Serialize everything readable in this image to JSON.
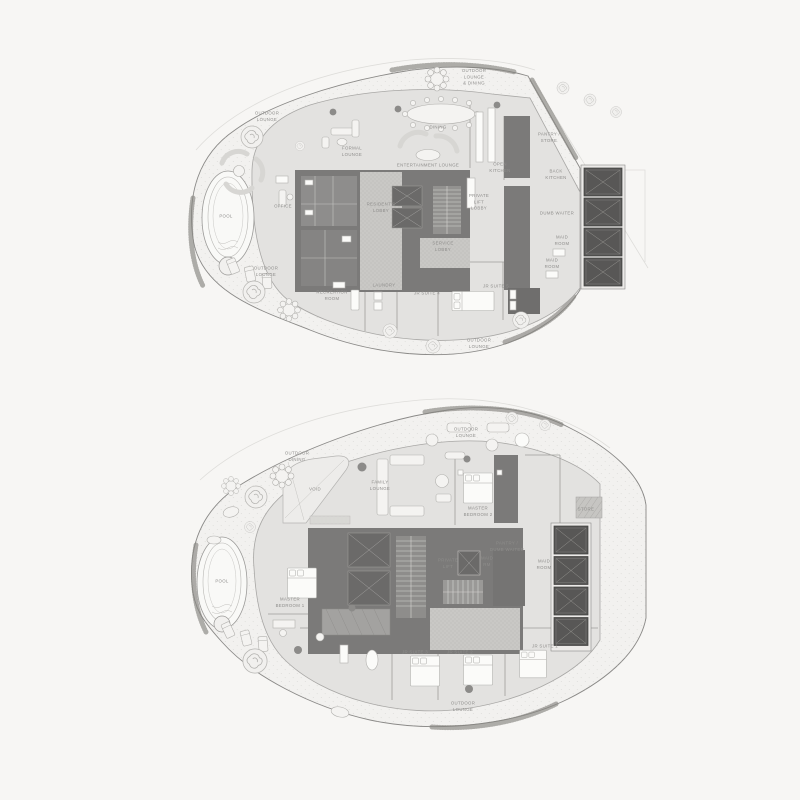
{
  "palette": {
    "background": "#f7f6f4",
    "terrace": "#f2f1ef",
    "floor_plate": "#e3e2e0",
    "core": "#7b7a79",
    "core_room": "#8e8d8c",
    "shaft": "#585756",
    "lobby_dots": "#c9c8c5",
    "label": "#8e8d8b",
    "plate_line": "#a8a7a5"
  },
  "plans": [
    {
      "id": "upper-level-plan",
      "labels": [
        {
          "text": "OUTDOOR\nLOUNGE",
          "x": 267,
          "y": 117
        },
        {
          "text": "OUTDOOR\nLOUNGE\n& DINING",
          "x": 474,
          "y": 78
        },
        {
          "text": "DINING",
          "x": 438,
          "y": 128
        },
        {
          "text": "FORMAL\nLOUNGE",
          "x": 352,
          "y": 152
        },
        {
          "text": "ENTERTAINMENT LOUNGE",
          "x": 428,
          "y": 166
        },
        {
          "text": "OPEN\nKITCHEN",
          "x": 500,
          "y": 168
        },
        {
          "text": "PANTRY /\nSTORE",
          "x": 549,
          "y": 138
        },
        {
          "text": "BACK\nKITCHEN",
          "x": 556,
          "y": 175
        },
        {
          "text": "PRIVATE\nLIFT\nLOBBY",
          "x": 479,
          "y": 203
        },
        {
          "text": "DUMB WAITER",
          "x": 557,
          "y": 214
        },
        {
          "text": "MAID\nROOM",
          "x": 562,
          "y": 241
        },
        {
          "text": "MAID\nROOM",
          "x": 552,
          "y": 264
        },
        {
          "text": "RESIDENT'S\nLOBBY",
          "x": 381,
          "y": 208
        },
        {
          "text": "SERVICE\nLOBBY",
          "x": 443,
          "y": 247
        },
        {
          "text": "OFFICE",
          "x": 283,
          "y": 207
        },
        {
          "text": "POOL",
          "x": 226,
          "y": 217
        },
        {
          "text": "OUTDOOR\nLOUNGE",
          "x": 266,
          "y": 272
        },
        {
          "text": "RECREATION\nROOM",
          "x": 332,
          "y": 296
        },
        {
          "text": "LAUNDRY",
          "x": 384,
          "y": 286
        },
        {
          "text": "JR SUITE 4",
          "x": 427,
          "y": 294
        },
        {
          "text": "JR SUITE 5",
          "x": 496,
          "y": 287
        },
        {
          "text": "OUTDOOR\nLOUNGE",
          "x": 479,
          "y": 344
        }
      ]
    },
    {
      "id": "lower-level-plan",
      "labels": [
        {
          "text": "OUTDOOR\nDINING",
          "x": 297,
          "y": 457
        },
        {
          "text": "OUTDOOR\nLOUNGE",
          "x": 466,
          "y": 433
        },
        {
          "text": "VOID",
          "x": 315,
          "y": 490
        },
        {
          "text": "FAMILY\nLOUNGE",
          "x": 380,
          "y": 486
        },
        {
          "text": "MASTER\nBEDROOM 2",
          "x": 478,
          "y": 512
        },
        {
          "text": "STORE",
          "x": 586,
          "y": 510
        },
        {
          "text": "PANTRY /\nDUMB WAITER",
          "x": 507,
          "y": 547
        },
        {
          "text": "PRIVATE\nLIFT",
          "x": 448,
          "y": 564
        },
        {
          "text": "MAID\nRM",
          "x": 487,
          "y": 562
        },
        {
          "text": "MAID\nROOM",
          "x": 544,
          "y": 565
        },
        {
          "text": "MASTER\nBEDROOM 1",
          "x": 290,
          "y": 603
        },
        {
          "text": "JR SUITE 3",
          "x": 415,
          "y": 653
        },
        {
          "text": "JR SUITE 2",
          "x": 460,
          "y": 653
        },
        {
          "text": "JR SUITE 1",
          "x": 545,
          "y": 647
        },
        {
          "text": "POOL",
          "x": 222,
          "y": 582
        },
        {
          "text": "OUTDOOR\nLOUNGE",
          "x": 463,
          "y": 707
        }
      ]
    }
  ]
}
